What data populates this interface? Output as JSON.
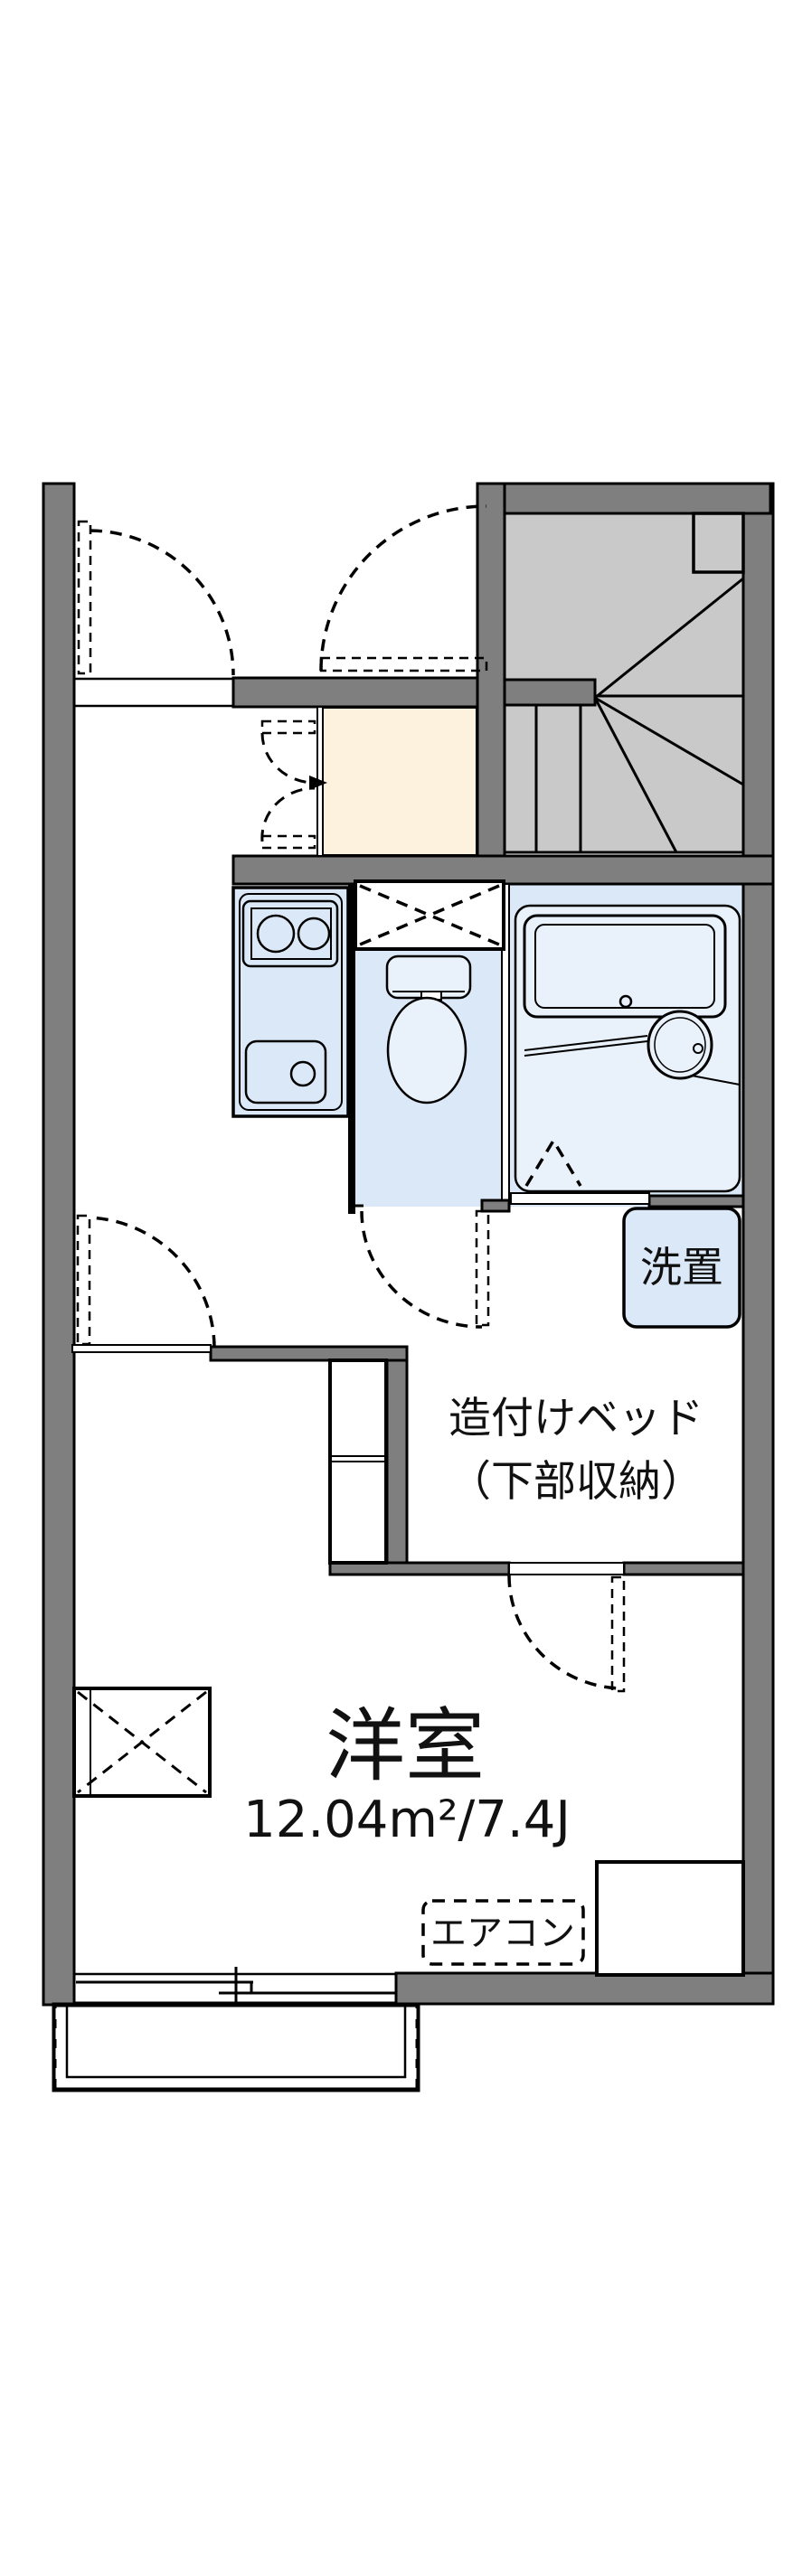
{
  "plan": {
    "rooms": {
      "western_room": {
        "name": "洋室",
        "area": "12.04m²/7.4J"
      },
      "built_in_bed": {
        "line1": "造付けベッド",
        "line2": "（下部収納）"
      },
      "laundry": {
        "label": "洗置"
      },
      "air_conditioner": {
        "label": "エアコン"
      }
    },
    "colors": {
      "wall_gray": "#7f7f7f",
      "outline_black": "#000000",
      "floor_blue": "#dbe8f7",
      "fixture_blue": "#e9f1fb",
      "genkan_cream": "#fdf2dd",
      "stairs_gray": "#c9c9c9"
    }
  }
}
